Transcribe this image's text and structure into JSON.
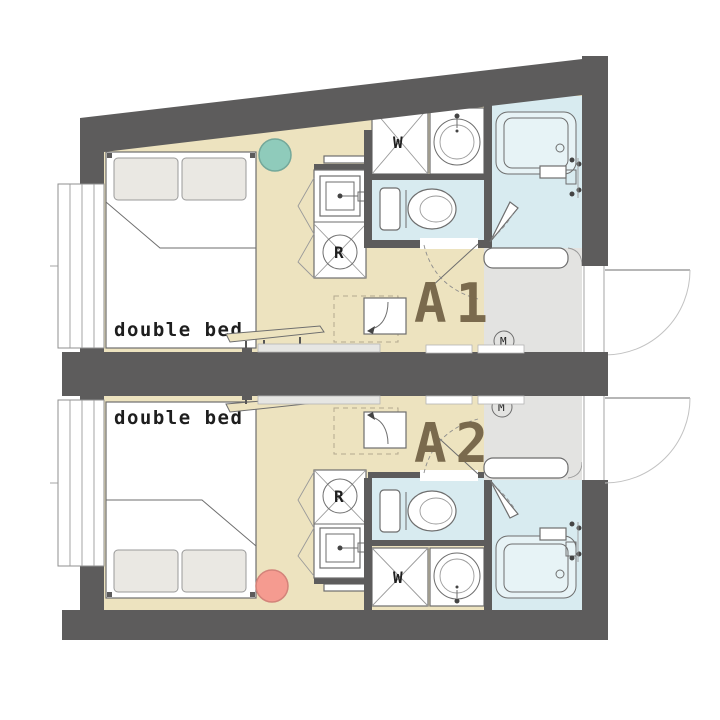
{
  "colors": {
    "wall": "#5d5c5c",
    "floor": "#ede3bf",
    "wet": "#d8ebf0",
    "tub_inner": "#e7f3f6",
    "entry": "#e3e3e1",
    "teal_marker": "#8fcbbb",
    "pink_marker": "#f59b90",
    "unit_label": "#7a6a4d",
    "text": "#1e1e1e",
    "dash": "#b3a88f"
  },
  "units": [
    {
      "id": "A1",
      "label": "A1",
      "bed_label": "double bed",
      "washer_label": "W",
      "fridge_label": "R",
      "meter_label": "M"
    },
    {
      "id": "A2",
      "label": "A2",
      "bed_label": "double bed",
      "washer_label": "W",
      "fridge_label": "R",
      "meter_label": "M"
    }
  ]
}
